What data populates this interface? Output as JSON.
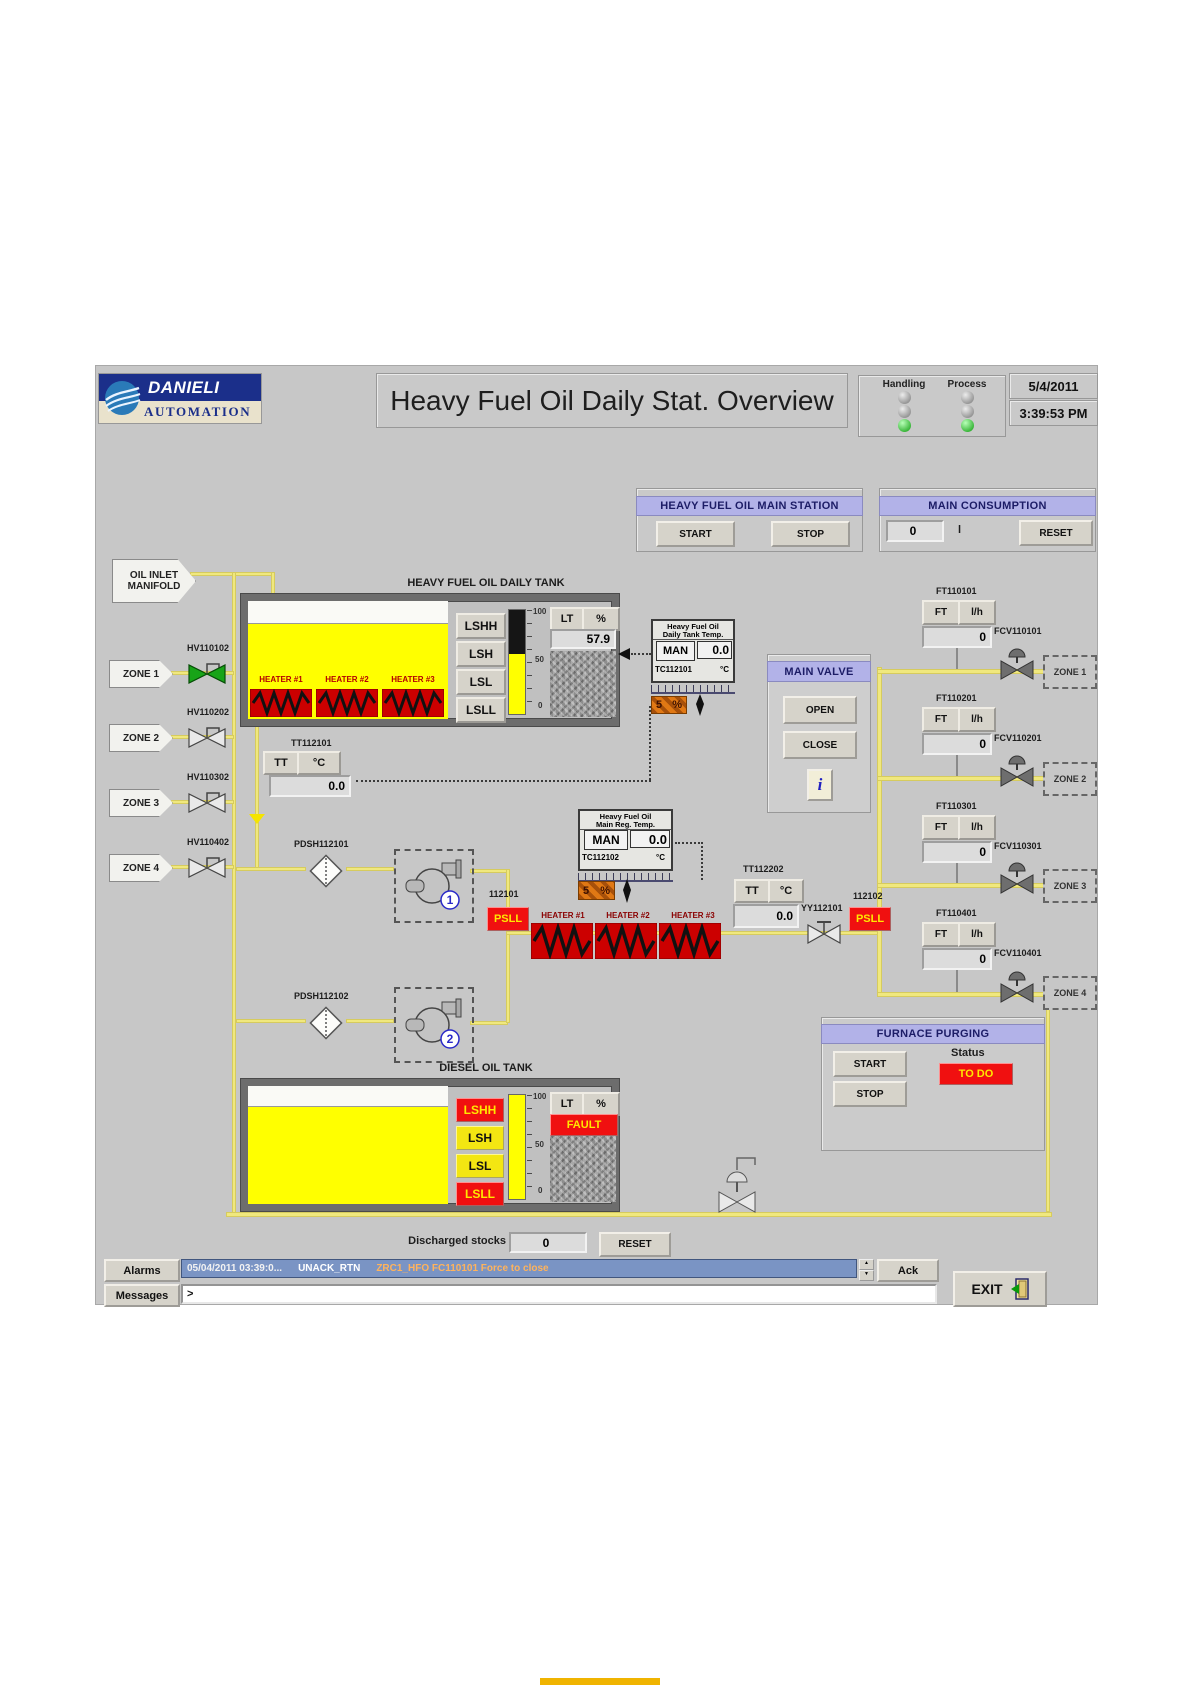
{
  "colors": {
    "header_accent": "#b2b2e8",
    "pipe_yellow": "#f0e87e",
    "tank_yellow": "#ffff00",
    "alarm_red": "#f01010",
    "ok_green": "#18b418",
    "alarm_bar_blue": "#7a94c4"
  },
  "header": {
    "logo": {
      "line1": "DANIELI",
      "line2": "AUTOMATION"
    },
    "title": "Heavy Fuel Oil Daily Stat. Overview",
    "status": {
      "handling_label": "Handling",
      "process_label": "Process"
    },
    "date": "5/4/2011",
    "time": "3:39:53 PM"
  },
  "main_station": {
    "title": "HEAVY FUEL OIL MAIN STATION",
    "start": "START",
    "stop": "STOP"
  },
  "main_consumption": {
    "title": "MAIN CONSUMPTION",
    "value": "0",
    "unit": "l",
    "reset": "RESET"
  },
  "inlet": {
    "tag_line1": "OIL INLET",
    "tag_line2": "MANIFOLD"
  },
  "zones_left": [
    {
      "tag": "ZONE 1",
      "valve": "HV110102"
    },
    {
      "tag": "ZONE 2",
      "valve": "HV110202"
    },
    {
      "tag": "ZONE 3",
      "valve": "HV110302"
    },
    {
      "tag": "ZONE 4",
      "valve": "HV110402"
    }
  ],
  "daily_tank": {
    "label": "HEAVY FUEL OIL DAILY TANK",
    "switches": [
      "LSHH",
      "LSH",
      "LSL",
      "LSLL"
    ],
    "heater_labels": [
      "HEATER #1",
      "HEATER #2",
      "HEATER #3"
    ],
    "scale": [
      "100",
      "50",
      "0"
    ],
    "lt": "LT",
    "pct": "%",
    "level_value": "57.9"
  },
  "daily_temp": {
    "title1": "Heavy Fuel Oil",
    "title2": "Daily Tank Temp.",
    "mode": "MAN",
    "value": "0.0",
    "tag": "TC112101",
    "unit": "°C",
    "out_value": "5",
    "out_unit": "%"
  },
  "tt112101": {
    "label": "TT112101",
    "tt": "TT",
    "unit": "°C",
    "value": "0.0"
  },
  "main_valve": {
    "title": "MAIN VALVE",
    "open": "OPEN",
    "close": "CLOSE",
    "info": "i"
  },
  "reg_temp": {
    "title1": "Heavy Fuel Oil",
    "title2": "Main Reg. Temp.",
    "mode": "MAN",
    "value": "0.0",
    "tag": "TC112102",
    "unit": "°C",
    "out_value": "5",
    "out_unit": "%"
  },
  "filters": {
    "f1": "PDSH112101",
    "f2": "PDSH112102"
  },
  "pumps": {
    "p1": "1",
    "p2": "2"
  },
  "heater_line": {
    "ps1_label": "112101",
    "ps1": "PSLL",
    "heaters": [
      "HEATER #1",
      "HEATER #2",
      "HEATER #3"
    ],
    "tt": {
      "label": "TT112202",
      "tt": "TT",
      "unit": "°C",
      "value": "0.0"
    },
    "yy_label": "YY112101",
    "ps2_label": "112102",
    "ps2": "PSLL"
  },
  "flow": [
    {
      "label": "FT110101",
      "ft": "FT",
      "unit": "l/h",
      "value": "0",
      "valve": "FCV110101",
      "zone": "ZONE 1"
    },
    {
      "label": "FT110201",
      "ft": "FT",
      "unit": "l/h",
      "value": "0",
      "valve": "FCV110201",
      "zone": "ZONE 2"
    },
    {
      "label": "FT110301",
      "ft": "FT",
      "unit": "l/h",
      "value": "0",
      "valve": "FCV110301",
      "zone": "ZONE 3"
    },
    {
      "label": "FT110401",
      "ft": "FT",
      "unit": "l/h",
      "value": "0",
      "valve": "FCV110401",
      "zone": "ZONE 4"
    }
  ],
  "furnace": {
    "title": "FURNACE PURGING",
    "start": "START",
    "stop": "STOP",
    "status_label": "Status",
    "status": "TO DO"
  },
  "diesel_tank": {
    "label": "DIESEL OIL TANK",
    "switches": [
      "LSHH",
      "LSH",
      "LSL",
      "LSLL"
    ],
    "scale": [
      "100",
      "50",
      "0"
    ],
    "lt": "LT",
    "pct": "%",
    "fault": "FAULT"
  },
  "discharged": {
    "label": "Discharged stocks",
    "value": "0",
    "reset": "RESET"
  },
  "alarm_bar": {
    "button": "Alarms",
    "time": "05/04/2011 03:39:0...",
    "state": "UNACK_RTN",
    "message": "ZRC1_HFO FC110101 Force to close",
    "ack": "Ack"
  },
  "message_bar": {
    "button": "Messages",
    "prompt": ">"
  },
  "exit_label": "EXIT"
}
